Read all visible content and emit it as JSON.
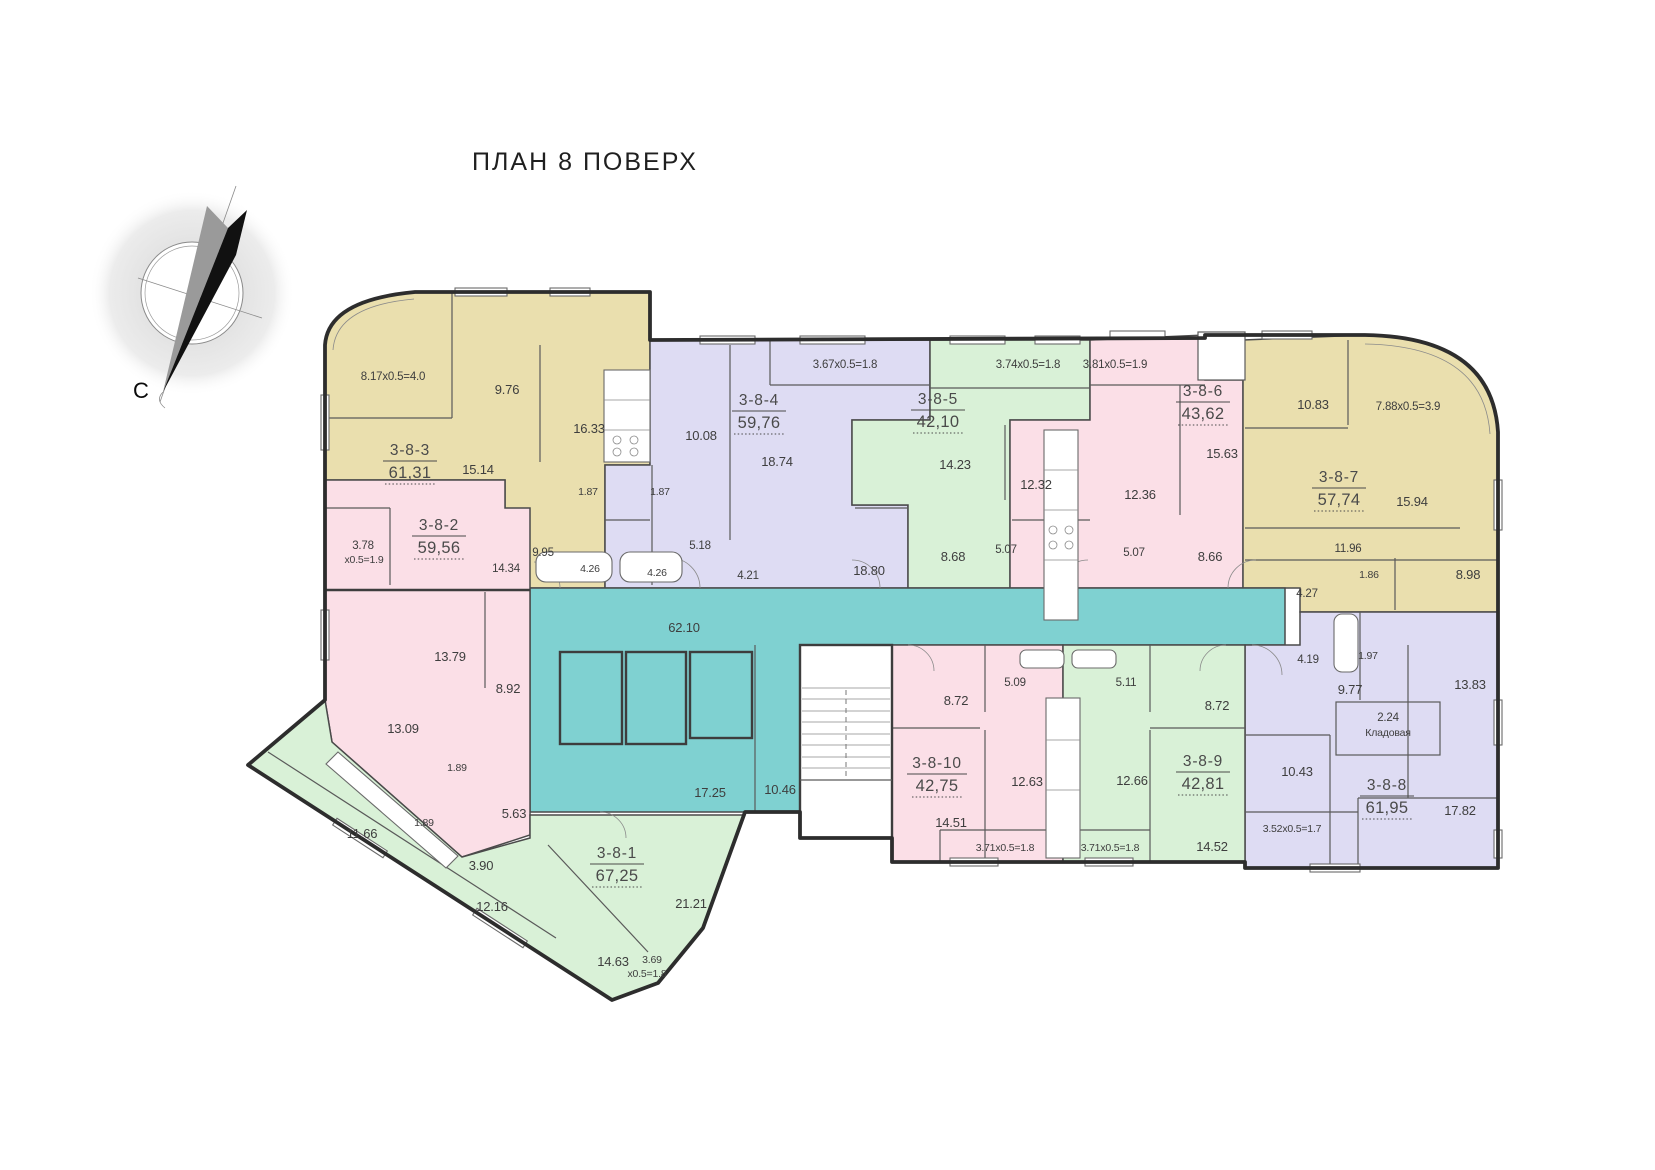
{
  "title": "ПЛАН 8 ПОВЕРХ",
  "compass": {
    "north_label": "С"
  },
  "colors": {
    "gold": "#eadfae",
    "lavender": "#dedcf3",
    "green": "#d9f1d7",
    "pink": "#fbdfe7",
    "teal": "#7fd1d1",
    "wall": "#2d2d2d"
  },
  "corridor": {
    "main_hall": "62.10",
    "lobby": "17.25",
    "hall": "10.46"
  },
  "apartments": [
    {
      "unit": "3-8-1",
      "total_area": "67,25",
      "rooms": [
        "11.66",
        "1.89",
        "3.90",
        "12.16",
        "14.63",
        "3.69",
        "х0.5=1.8",
        "21.21"
      ]
    },
    {
      "unit": "3-8-2",
      "total_area": "59,56",
      "rooms": [
        "3.78",
        "х0.5=1.9",
        "14.34",
        "13.79",
        "8.92",
        "13.09",
        "1.89",
        "5.63"
      ]
    },
    {
      "unit": "3-8-3",
      "total_area": "61,31",
      "rooms": [
        "8.17х0.5=4.0",
        "9.76",
        "16.33",
        "15.14",
        "1.87",
        "9.95",
        "4.26"
      ]
    },
    {
      "unit": "3-8-4",
      "total_area": "59,76",
      "rooms": [
        "3.67х0.5=1.8",
        "10.08",
        "18.74",
        "1.87",
        "5.18",
        "4.26",
        "4.21",
        "18.80"
      ]
    },
    {
      "unit": "3-8-5",
      "total_area": "42,10",
      "rooms": [
        "3.74х0.5=1.8",
        "14.23",
        "12.32",
        "8.68",
        "5.07"
      ]
    },
    {
      "unit": "3-8-6",
      "total_area": "43,62",
      "rooms": [
        "3.81х0.5=1.9",
        "15.63",
        "12.36",
        "5.07",
        "8.66"
      ]
    },
    {
      "unit": "3-8-7",
      "total_area": "57,74",
      "rooms": [
        "10.83",
        "7.88х0.5=3.9",
        "15.94",
        "11.96",
        "1.86",
        "4.27",
        "8.98"
      ]
    },
    {
      "unit": "3-8-8",
      "total_area": "61,95",
      "rooms": [
        "4.19",
        "1.97",
        "9.77",
        "13.83",
        "2.24",
        "Кладовая",
        "10.43",
        "17.82",
        "3.52х0.5=1.7"
      ]
    },
    {
      "unit": "3-8-9",
      "total_area": "42,81",
      "rooms": [
        "5.11",
        "8.72",
        "12.66",
        "14.52",
        "3.71х0.5=1.8"
      ]
    },
    {
      "unit": "3-8-10",
      "total_area": "42,75",
      "rooms": [
        "8.72",
        "5.09",
        "12.63",
        "14.51",
        "3.71х0.5=1.8"
      ]
    }
  ]
}
